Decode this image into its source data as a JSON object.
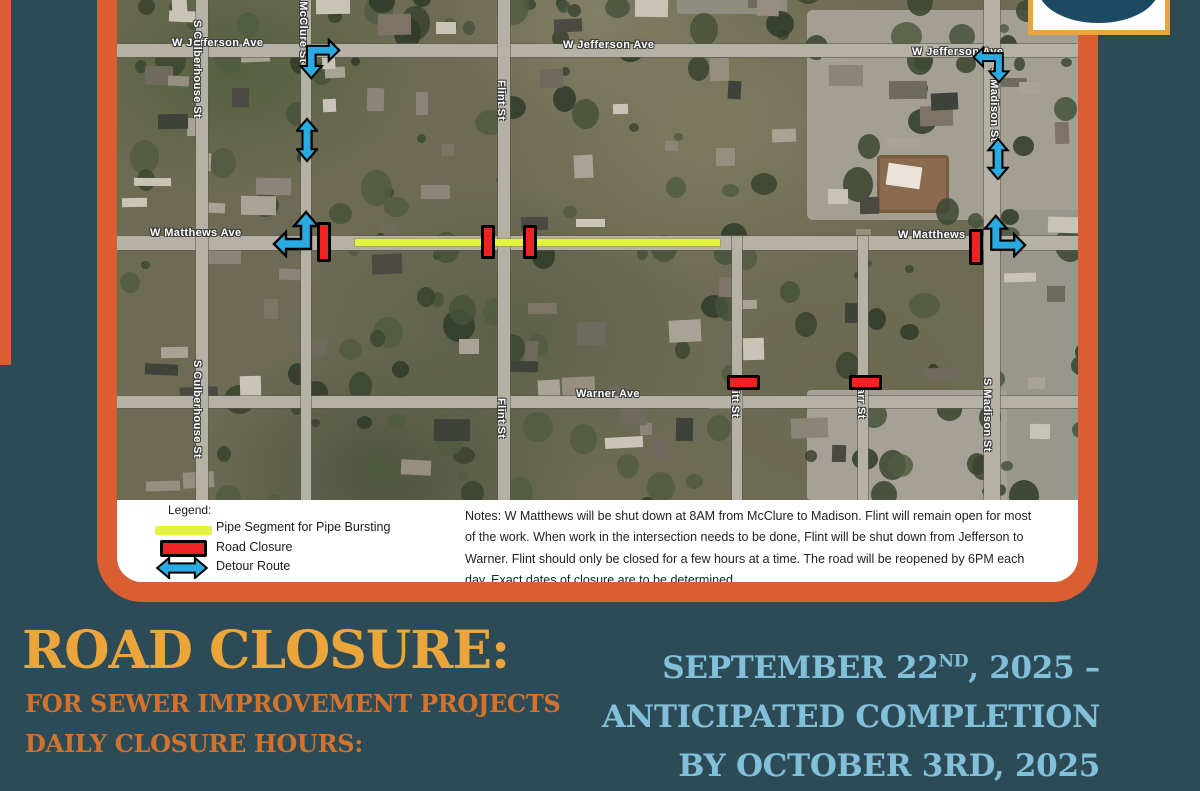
{
  "map": {
    "labels": {
      "jefferson_left": "W Jefferson Ave",
      "jefferson_center": "W Jefferson Ave",
      "jefferson_right": "W Jefferson Ave",
      "matthews_left": "W Matthews Ave",
      "matthews_right": "W Matthews",
      "warner": "Warner Ave",
      "culberhouse_top": "S Culberhouse St",
      "culberhouse_bottom": "S Culberhouse St",
      "mcclure": "S McClure St",
      "flint_top": "Flint St",
      "flint_bottom": "Flint St",
      "witt": "Witt St",
      "parr": "Parr St",
      "madison_top": "S Madison St",
      "madison_bottom": "S Madison St"
    }
  },
  "legend": {
    "title": "Legend:",
    "items": [
      {
        "key": "pipe",
        "label": "Pipe Segment for Pipe Bursting"
      },
      {
        "key": "closure",
        "label": "Road Closure"
      },
      {
        "key": "detour",
        "label": "Detour Route"
      }
    ]
  },
  "notes": "Notes: W Matthews will be shut down at 8AM from McClure to Madison. Flint will remain open for most of the work. When work in the intersection needs to be done, Flint will be shut down from Jefferson to Warner. Flint should only be closed for a few hours at a time. The road will be reopened by 6PM each day.  Exact dates of closure are to be determined.",
  "footer": {
    "title": "ROAD CLOSURE:",
    "subtitle1": "FOR SEWER IMPROVEMENT PROJECTS",
    "subtitle2": "DAILY CLOSURE HOURS:",
    "dates": {
      "line1_pre": "SEPTEMBER 22",
      "line1_sup": "ND",
      "line1_post": ", 2025 –",
      "line2": "ANTICIPATED COMPLETION",
      "line3": "BY OCTOBER 3RD, 2025"
    }
  },
  "colors": {
    "background": "#2d4a57",
    "frame_orange": "#d95f32",
    "gold": "#eca53b",
    "subtitle_orange": "#d2722b",
    "date_blue": "#82c0d9",
    "pipe_yellow": "#e3f43e",
    "closure_red": "#ee2424",
    "detour_blue": "#29abe2",
    "logo_navy": "#1d4a63"
  }
}
